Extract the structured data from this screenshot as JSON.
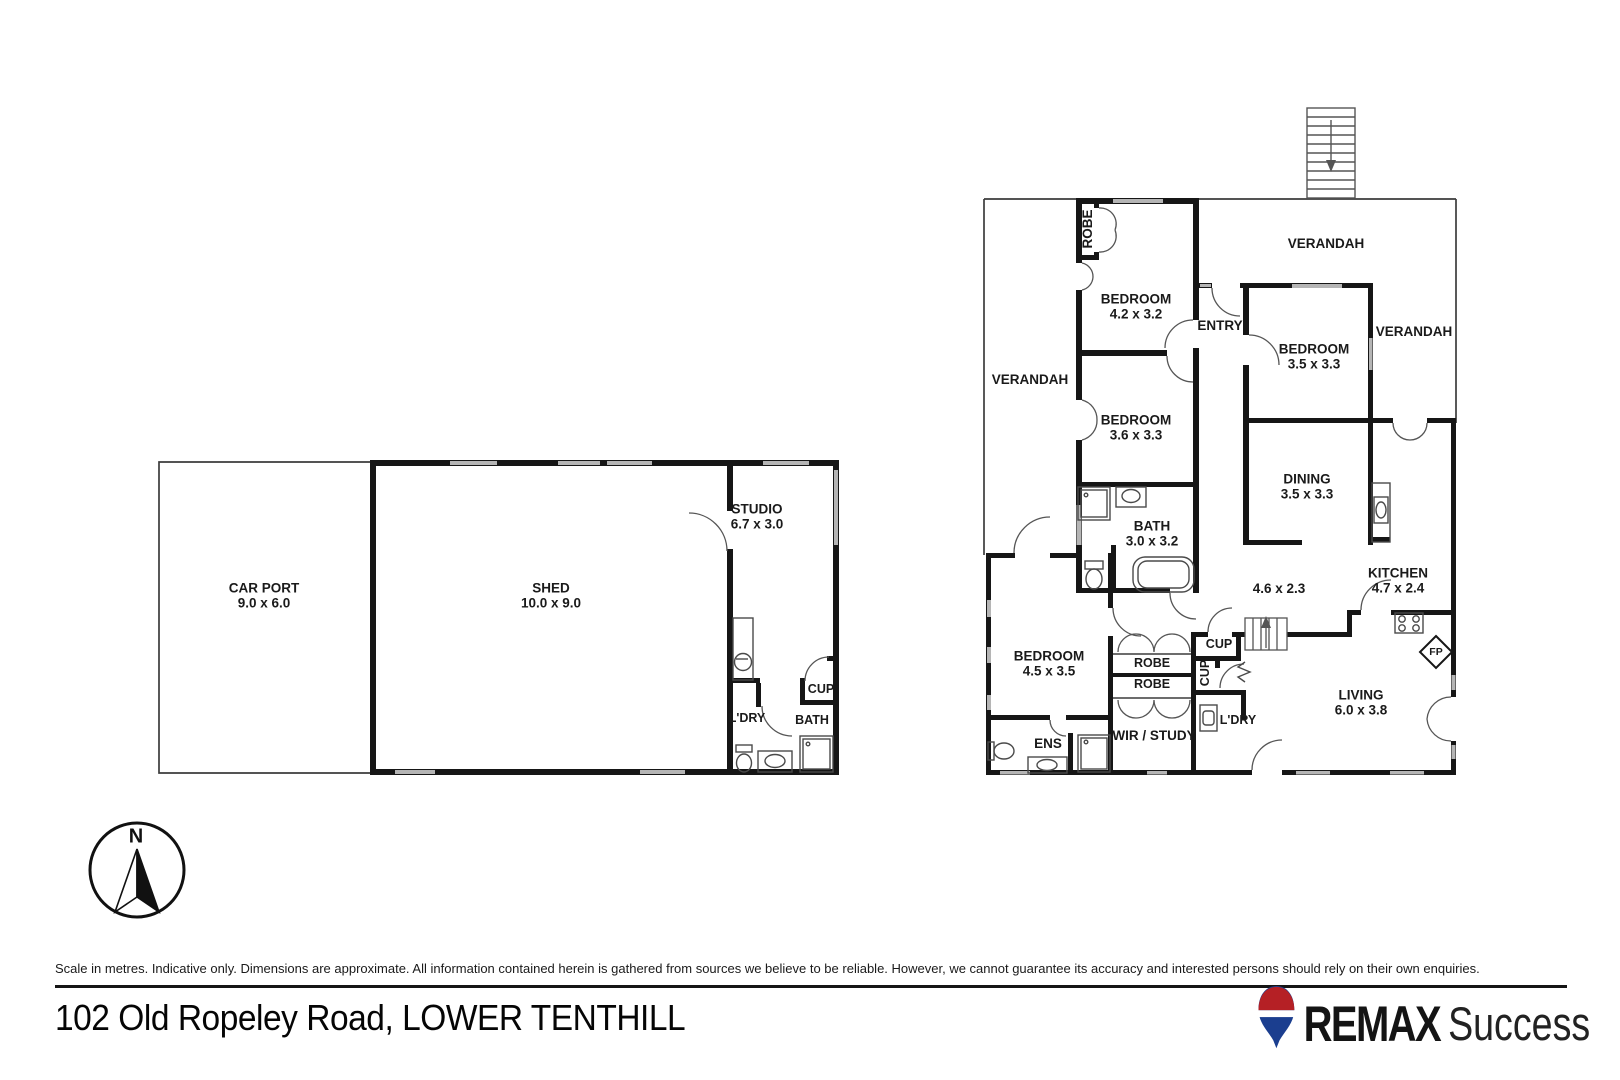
{
  "meta": {
    "address": "102 Old Ropeley Road, LOWER TENTHILL",
    "disclaimer": "Scale in metres. Indicative only. Dimensions are approximate. All information contained herein is gathered from sources we believe to be reliable. However, we cannot guarantee its accuracy and interested persons should rely on their own enquiries."
  },
  "compass": {
    "label": "N"
  },
  "brand": {
    "name": "REMAX",
    "suffix": "Success",
    "balloon_red": "#b52025",
    "balloon_blue": "#1b3e8f"
  },
  "outbuilding": {
    "carport": {
      "name": "CAR PORT",
      "dims": "9.0 x 6.0"
    },
    "shed": {
      "name": "SHED",
      "dims": "10.0 x 9.0"
    },
    "studio": {
      "name": "STUDIO",
      "dims": "6.7 x 3.0"
    },
    "laundry": {
      "name": "L'DRY"
    },
    "bath": {
      "name": "BATH"
    },
    "cupboard": {
      "name": "CUP"
    }
  },
  "house": {
    "verandah_top": "VERANDAH",
    "verandah_left": "VERANDAH",
    "verandah_right": "VERANDAH",
    "robe_top": "ROBE",
    "entry": "ENTRY",
    "bedroom1": {
      "name": "BEDROOM",
      "dims": "4.2 x 3.2"
    },
    "bedroom2": {
      "name": "BEDROOM",
      "dims": "3.5 x 3.3"
    },
    "bedroom3": {
      "name": "BEDROOM",
      "dims": "3.6 x 3.3"
    },
    "bedroom4": {
      "name": "BEDROOM",
      "dims": "4.5 x 3.5"
    },
    "dining": {
      "name": "DINING",
      "dims": "3.5 x 3.3"
    },
    "bath": {
      "name": "BATH",
      "dims": "3.0 x 3.2"
    },
    "hall": {
      "dims": "4.6 x 2.3"
    },
    "kitchen": {
      "name": "KITCHEN",
      "dims": "4.7 x 2.4"
    },
    "living": {
      "name": "LIVING",
      "dims": "6.0 x 3.8"
    },
    "robe1": "ROBE",
    "robe2": "ROBE",
    "cup1": "CUP",
    "cup2": "CUP",
    "laundry": "L'DRY",
    "wir": "WIR / STUDY",
    "ens": "ENS",
    "fireplace": "FP"
  }
}
